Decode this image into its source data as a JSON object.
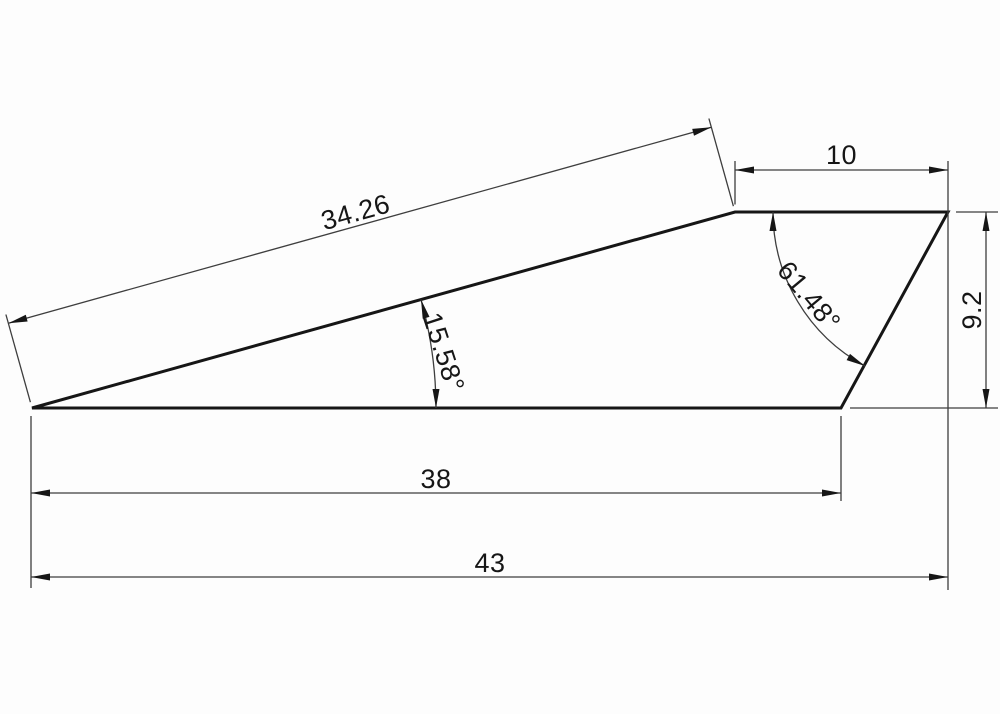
{
  "drawing": {
    "labels": {
      "slope_length": "34.26",
      "top_width": "10",
      "right_height": "9.2",
      "bottom_width": "38",
      "overall_width": "43",
      "slope_angle": "15.58°",
      "corner_angle": "61.48°"
    },
    "colors": {
      "outline": "#161616",
      "dimension": "#3e3e3e",
      "background": "#fdfdfd"
    }
  }
}
